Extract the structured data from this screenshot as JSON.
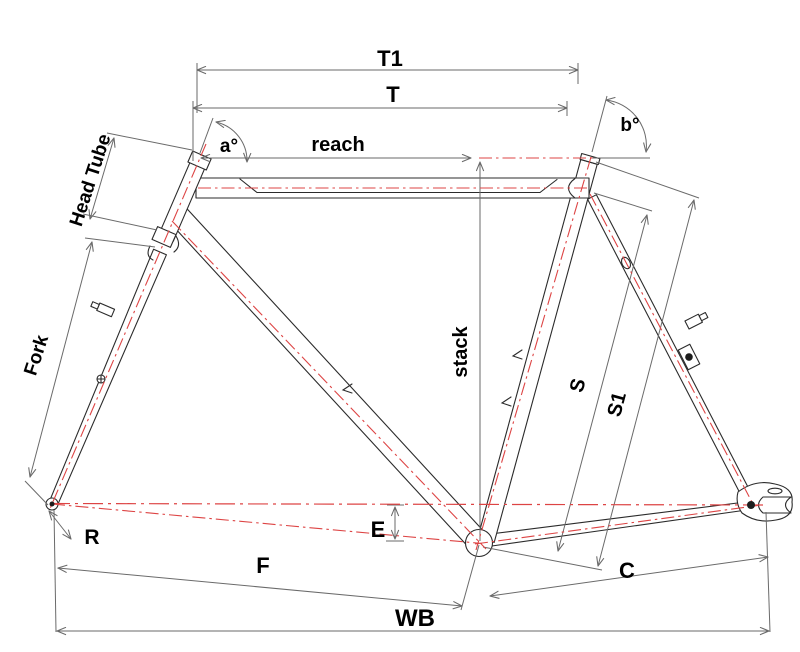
{
  "labels": {
    "t1": "T1",
    "t": "T",
    "reach": "reach",
    "stack": "stack",
    "head_tube": "Head Tube",
    "fork": "Fork",
    "angle_a": "a°",
    "angle_b": "b°",
    "s": "S",
    "s1": "S1",
    "e": "E",
    "r": "R",
    "f": "F",
    "c": "C",
    "wb": "WB"
  },
  "colors": {
    "background": "#ffffff",
    "frame_outline": "#2b2b2b",
    "centerline_red": "#dd4444",
    "dimension_gray": "#6a6a6a",
    "label_black": "#000000"
  }
}
